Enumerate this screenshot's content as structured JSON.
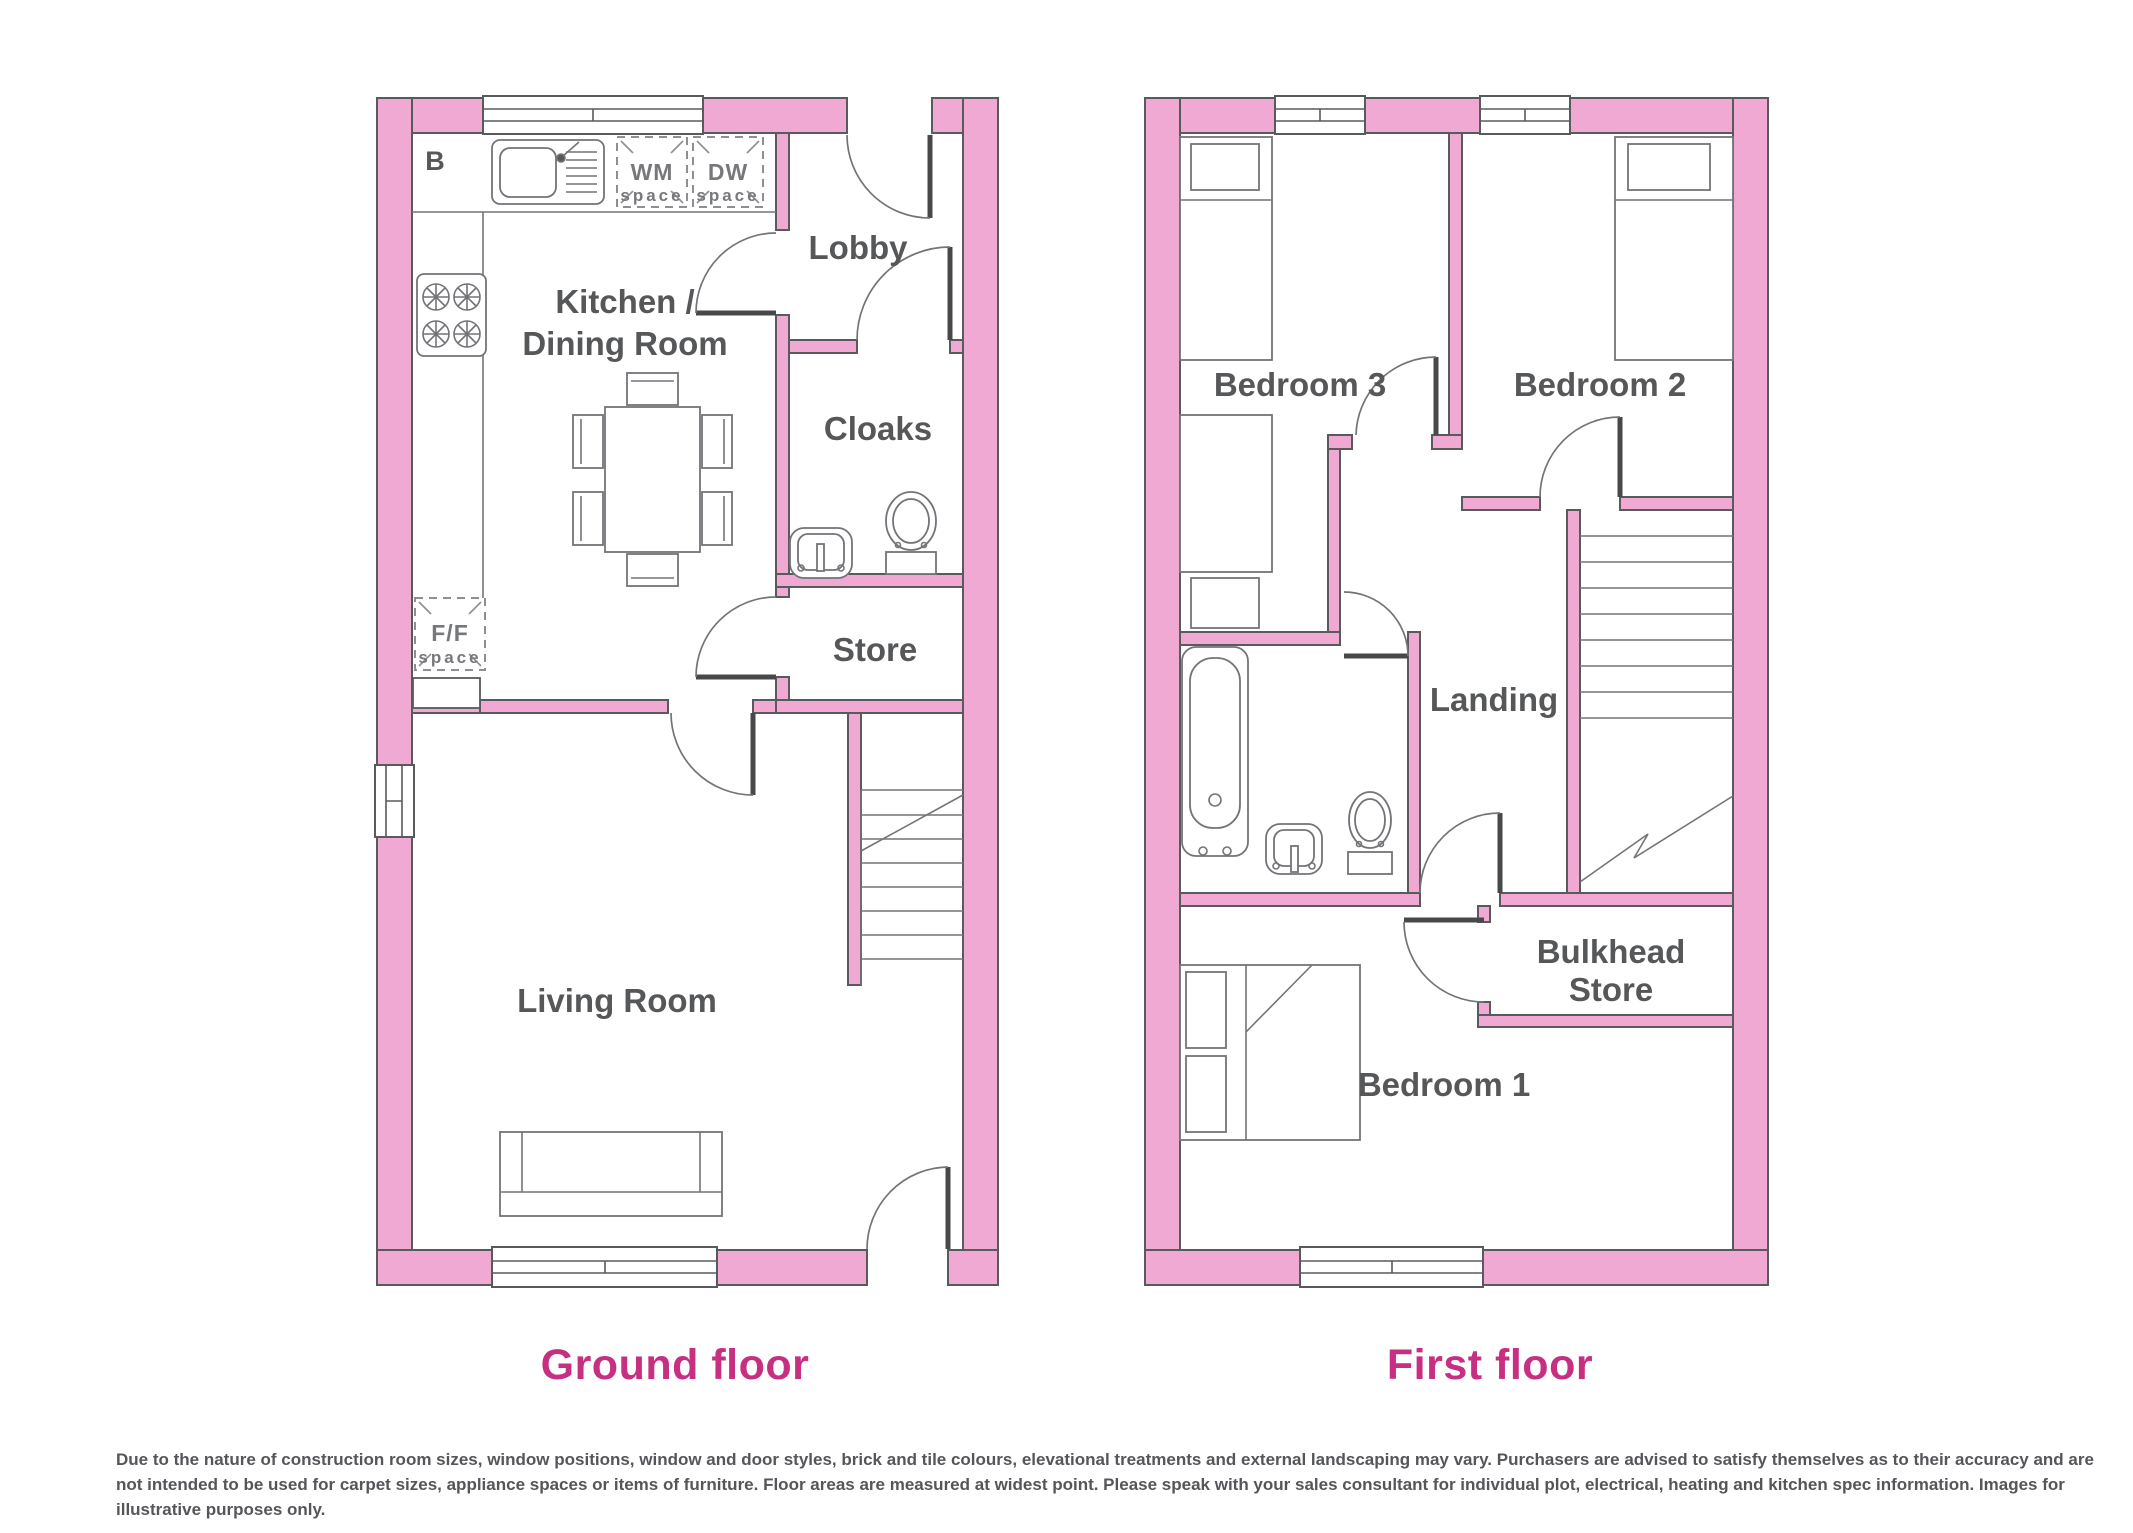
{
  "colors": {
    "wall_fill": "#F0A9D2",
    "wall_stroke": "#595A5C",
    "furniture_stroke": "#737478",
    "label": "#565759",
    "title": "#C72F82",
    "leaf": "#474849",
    "disclaimer": "#55565A"
  },
  "ground_floor": {
    "title": "Ground floor",
    "labels": {
      "boiler": "B",
      "kitchen_line1": "Kitchen /",
      "kitchen_line2": "Dining Room",
      "lobby": "Lobby",
      "cloaks": "Cloaks",
      "store": "Store",
      "living_room": "Living Room"
    },
    "appliance_spaces": {
      "wm": {
        "line1": "WM",
        "line2": "space"
      },
      "dw": {
        "line1": "DW",
        "line2": "space"
      },
      "ff": {
        "line1": "F/F",
        "line2": "space"
      }
    }
  },
  "first_floor": {
    "title": "First floor",
    "labels": {
      "bedroom3": "Bedroom 3",
      "bedroom2": "Bedroom 2",
      "landing": "Landing",
      "bulkhead_line1": "Bulkhead",
      "bulkhead_line2": "Store",
      "bedroom1": "Bedroom 1"
    }
  },
  "disclaimer": {
    "line1": "Due to the nature of construction room sizes, window positions, window and door styles, brick and tile colours, elevational treatments and external landscaping may vary. Purchasers are advised to satisfy themselves as to their accuracy and are",
    "line2": "not intended to be used for carpet sizes, appliance spaces or items of furniture. Floor areas are measured at widest point. Please speak with your sales consultant for individual plot, electrical, heating and kitchen spec information. Images for",
    "line3": "illustrative purposes only."
  }
}
